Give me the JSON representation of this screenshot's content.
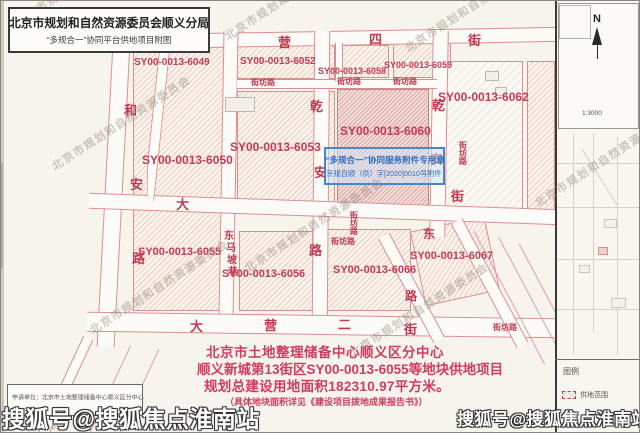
{
  "colors": {
    "parcel_label_red": "#c43b55",
    "street_name_red": "#c0394f",
    "notes_pink": "#d13b5e",
    "stamp_blue": "#2f6fbe",
    "map_line_pink": "#d98f8f",
    "watermark_gray": "#968e80"
  },
  "title_box": {
    "title": "北京市规划和自然资源委员会顺义分局",
    "subtitle": "“多规合一”协同平台供地项目附图"
  },
  "stamp": {
    "line1": "“多规合一”协同服务附件专用章",
    "line2": "京规自顺（供）字[2020]0010号附件"
  },
  "notes": {
    "line1": "北京市土地整理储备中心顺义区分中心",
    "line2": "顺义新城第13街区SY00-0013-6055等地块供地项目",
    "line3": "规划总建设用地面积182310.97平方米。",
    "line4": "（具体地块面积详见《建设项目拨地成果报告书》）"
  },
  "info_box": {
    "applicant": "申请单位：北京市土地整理储备中心顺义区分中心",
    "sheet_no": "图纸号：1559B-01"
  },
  "compass": {
    "north_label": "N",
    "scale_text": "1:3000"
  },
  "legend": {
    "title": "图例",
    "items": [
      {
        "symbol": "supply-area-hatched-box",
        "label": "供地范围"
      }
    ]
  },
  "watermarks": {
    "sohu": "搜狐号@搜狐焦点淮南站",
    "diagonal_text": "北京市规划和自然资源委员会",
    "diagonal_positions": [
      {
        "x": 15,
        "y": 14
      },
      {
        "x": 225,
        "y": 28
      },
      {
        "x": 405,
        "y": 40
      },
      {
        "x": 52,
        "y": 158
      },
      {
        "x": 245,
        "y": 260
      },
      {
        "x": 350,
        "y": 345
      },
      {
        "x": 535,
        "y": 195
      },
      {
        "x": 90,
        "y": 322
      }
    ]
  },
  "map": {
    "parcels": [
      {
        "x": 132,
        "y": 46,
        "w": 94,
        "h": 264,
        "style": "light"
      },
      {
        "x": 236,
        "y": 44,
        "w": 98,
        "h": 34,
        "style": "light"
      },
      {
        "x": 340,
        "y": 44,
        "w": 48,
        "h": 33,
        "style": "light"
      },
      {
        "x": 392,
        "y": 42,
        "w": 58,
        "h": 35,
        "style": "light"
      },
      {
        "x": 236,
        "y": 90,
        "w": 98,
        "h": 118,
        "style": "light"
      },
      {
        "x": 336,
        "y": 88,
        "w": 92,
        "h": 124,
        "style": "dense"
      },
      {
        "x": 436,
        "y": 60,
        "w": 86,
        "h": 152,
        "style": "faint"
      },
      {
        "x": 526,
        "y": 60,
        "w": 28,
        "h": 150,
        "style": "light"
      },
      {
        "x": 238,
        "y": 230,
        "w": 74,
        "h": 80,
        "style": "light"
      },
      {
        "x": 326,
        "y": 228,
        "w": 84,
        "h": 82,
        "style": "light"
      },
      {
        "x": 416,
        "y": 222,
        "w": 76,
        "h": 76,
        "style": "light",
        "rot": -12
      }
    ],
    "streets": [
      {
        "o": "h",
        "x": 88,
        "y": 30,
        "w": 467,
        "h": 15,
        "rot": -1
      },
      {
        "o": "v",
        "x": 104,
        "y": 24,
        "w": 18,
        "h": 322,
        "rot": 3
      },
      {
        "o": "v",
        "x": 220,
        "y": 30,
        "w": 15,
        "h": 288,
        "rot": 1
      },
      {
        "o": "v",
        "x": 312,
        "y": 30,
        "w": 16,
        "h": 288,
        "rot": 0.5
      },
      {
        "o": "v",
        "x": 430,
        "y": 30,
        "w": 16,
        "h": 206,
        "rot": 1
      },
      {
        "o": "h",
        "x": 236,
        "y": 78,
        "w": 200,
        "h": 10,
        "rot": 0
      },
      {
        "o": "v",
        "x": 334,
        "y": 42,
        "w": 8,
        "h": 38,
        "rot": 0
      },
      {
        "o": "h",
        "x": 88,
        "y": 200,
        "w": 470,
        "h": 16,
        "rot": 2
      },
      {
        "o": "h",
        "x": 86,
        "y": 314,
        "w": 470,
        "h": 20,
        "rot": 0.8
      },
      {
        "o": "v",
        "x": 404,
        "y": 228,
        "w": 13,
        "h": 118,
        "rot": -28
      },
      {
        "o": "v",
        "x": 482,
        "y": 212,
        "w": 13,
        "h": 140,
        "rot": -28
      },
      {
        "o": "v",
        "x": 150,
        "y": 50,
        "w": 11,
        "h": 150,
        "rot": 6,
        "curve": true
      },
      {
        "o": "v",
        "x": 58,
        "y": 332,
        "w": 11,
        "h": 112,
        "rot": 25
      }
    ],
    "thin_lines": [
      {
        "x": 508,
        "y": 222,
        "h": 150,
        "rot": -28
      },
      {
        "x": 530,
        "y": 228,
        "h": 140,
        "rot": -28
      },
      {
        "x": 548,
        "y": 235,
        "h": 130,
        "rot": -28
      },
      {
        "x": 108,
        "y": 340,
        "h": 100,
        "rot": 25
      },
      {
        "x": 138,
        "y": 344,
        "h": 92,
        "rot": 25
      }
    ],
    "street_chars": [
      {
        "t": "大",
        "x": 180,
        "y": 37,
        "s": 13
      },
      {
        "t": "营",
        "x": 277,
        "y": 35,
        "s": 13
      },
      {
        "t": "四",
        "x": 368,
        "y": 32,
        "s": 13
      },
      {
        "t": "街",
        "x": 467,
        "y": 33,
        "s": 13
      },
      {
        "t": "和",
        "x": 123,
        "y": 103,
        "s": 13
      },
      {
        "t": "安",
        "x": 129,
        "y": 177,
        "s": 13
      },
      {
        "t": "路",
        "x": 131,
        "y": 251,
        "s": 13
      },
      {
        "t": "大",
        "x": 175,
        "y": 197,
        "s": 13
      },
      {
        "t": "东",
        "x": 223,
        "y": 231,
        "s": 10
      },
      {
        "t": "马",
        "x": 225,
        "y": 243,
        "s": 10
      },
      {
        "t": "坡",
        "x": 226,
        "y": 255,
        "s": 10
      },
      {
        "t": "巷",
        "x": 227,
        "y": 267,
        "s": 10
      },
      {
        "t": "乾",
        "x": 309,
        "y": 99,
        "s": 13
      },
      {
        "t": "安",
        "x": 313,
        "y": 165,
        "s": 13
      },
      {
        "t": "路",
        "x": 308,
        "y": 243,
        "s": 13
      },
      {
        "t": "乾",
        "x": 431,
        "y": 98,
        "s": 13
      },
      {
        "t": "安",
        "x": 429,
        "y": 152,
        "s": 13
      },
      {
        "t": "街",
        "x": 450,
        "y": 189,
        "s": 13
      },
      {
        "t": "东",
        "x": 422,
        "y": 227,
        "s": 12
      },
      {
        "t": "路",
        "x": 404,
        "y": 289,
        "s": 12
      },
      {
        "t": "大",
        "x": 189,
        "y": 319,
        "s": 13
      },
      {
        "t": "营",
        "x": 263,
        "y": 318,
        "s": 13
      },
      {
        "t": "二",
        "x": 337,
        "y": 317,
        "s": 13
      },
      {
        "t": "街",
        "x": 403,
        "y": 322,
        "s": 13
      }
    ],
    "road_small_labels": [
      {
        "t": "街坊路",
        "x": 250,
        "y": 78,
        "vert": false
      },
      {
        "t": "街坊路",
        "x": 336,
        "y": 77,
        "vert": false
      },
      {
        "t": "街坊路",
        "x": 392,
        "y": 77,
        "vert": false
      },
      {
        "t": "街坊路",
        "x": 457,
        "y": 140,
        "vert": true
      },
      {
        "t": "街坊路",
        "x": 348,
        "y": 210,
        "vert": true
      },
      {
        "t": "街坊路",
        "x": 330,
        "y": 237,
        "vert": false
      },
      {
        "t": "街坊路",
        "x": 492,
        "y": 323,
        "vert": false
      }
    ],
    "parcel_labels": [
      {
        "t": "SY00-0013-6049",
        "x": 133,
        "y": 57,
        "s": 10
      },
      {
        "t": "SY00-0013-6052",
        "x": 239,
        "y": 56,
        "s": 10
      },
      {
        "t": "SY00-0013-6058",
        "x": 317,
        "y": 66,
        "s": 9
      },
      {
        "t": "SY00-0013-6059",
        "x": 383,
        "y": 60,
        "s": 9
      },
      {
        "t": "SY00-0013-6053",
        "x": 229,
        "y": 140,
        "s": 12
      },
      {
        "t": "SY00-0013-6060",
        "x": 339,
        "y": 124,
        "s": 12
      },
      {
        "t": "SY00-0013-6062",
        "x": 437,
        "y": 90,
        "s": 12
      },
      {
        "t": "SY00-0013-6050",
        "x": 141,
        "y": 153,
        "s": 12
      },
      {
        "t": "SY00-0013-6055",
        "x": 137,
        "y": 246,
        "s": 11
      },
      {
        "t": "SY00-0013-6056",
        "x": 221,
        "y": 268,
        "s": 11
      },
      {
        "t": "SY00-0013-6066",
        "x": 332,
        "y": 264,
        "s": 11
      },
      {
        "t": "SY00-0013-6067",
        "x": 409,
        "y": 250,
        "s": 11
      }
    ],
    "buildings": [
      {
        "x": 224,
        "y": 96,
        "w": 30,
        "h": 15
      },
      {
        "x": 484,
        "y": 70,
        "w": 14,
        "h": 10
      },
      {
        "x": 494,
        "y": 86,
        "w": 12,
        "h": 9
      }
    ]
  },
  "inset": {
    "lines": [
      {
        "x": 572,
        "y": 132,
        "w": 1,
        "h": 222
      },
      {
        "x": 592,
        "y": 132,
        "w": 1,
        "h": 200
      },
      {
        "x": 616,
        "y": 136,
        "w": 1,
        "h": 218
      },
      {
        "x": 556,
        "y": 162,
        "w": 83,
        "h": 1
      },
      {
        "x": 556,
        "y": 206,
        "w": 83,
        "h": 1
      },
      {
        "x": 556,
        "y": 258,
        "w": 83,
        "h": 1
      },
      {
        "x": 556,
        "y": 308,
        "w": 83,
        "h": 1
      },
      {
        "x": 598,
        "y": 143,
        "w": 1,
        "h": 66,
        "rot": -32
      }
    ],
    "boxes": [
      {
        "x": 603,
        "y": 218,
        "w": 13,
        "h": 9
      },
      {
        "x": 578,
        "y": 264,
        "w": 11,
        "h": 8
      },
      {
        "x": 610,
        "y": 297,
        "w": 15,
        "h": 10
      }
    ],
    "highlight": {
      "x": 597,
      "y": 246,
      "w": 10,
      "h": 8
    }
  }
}
